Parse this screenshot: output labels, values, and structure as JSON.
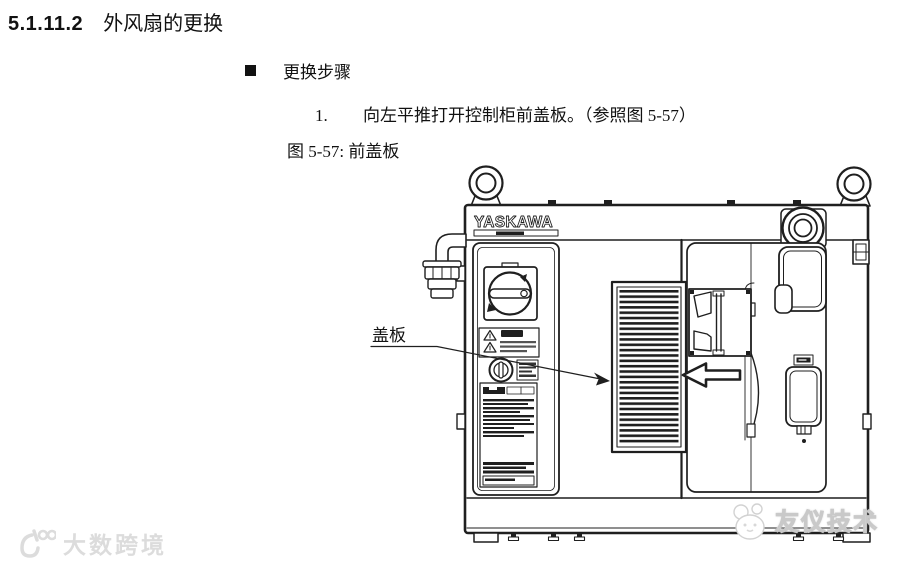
{
  "page": {
    "section_number": "5.1.11.2",
    "section_title": "外风扇的更换",
    "steps_heading": "更换步骤",
    "step_number": "1.",
    "step_text": "向左平推打开控制柜前盖板。（参照图 5-57）",
    "figure_caption": "图 5-57: 前盖板"
  },
  "figure": {
    "brand_logo": "YASKAWA",
    "cover_label": "盖板"
  },
  "watermarks": {
    "bottom_left_text": "大数跨境",
    "bottom_right_text": "友仪技术"
  },
  "colors": {
    "ink": "#1f1f1f",
    "background": "#ffffff",
    "watermark_left_gray": "#dcdcdc",
    "watermark_right_white": "#ffffff"
  }
}
